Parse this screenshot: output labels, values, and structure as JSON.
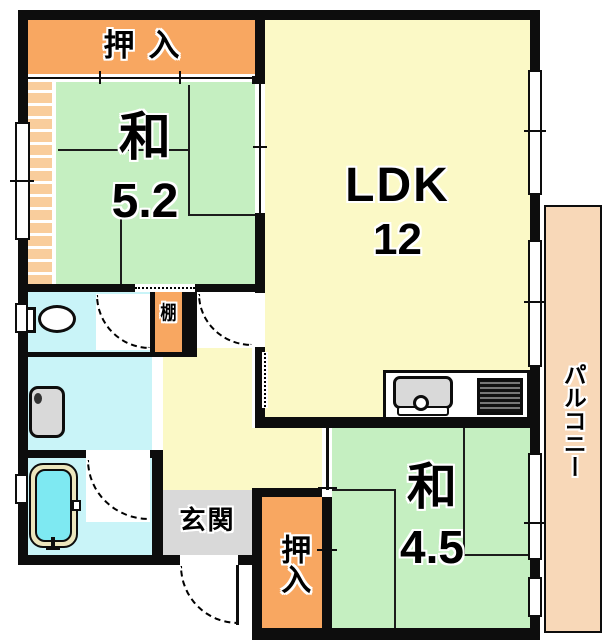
{
  "rooms": {
    "closet_top": {
      "label": "押入",
      "type": "closet"
    },
    "washitsu_main": {
      "label": "和",
      "size": "5.2",
      "type": "japanese-room"
    },
    "ldk": {
      "label": "LDK",
      "size": "12",
      "type": "living-dining-kitchen"
    },
    "balcony": {
      "label": "パルコニー",
      "type": "balcony"
    },
    "shelf": {
      "label": "棚",
      "type": "shelf"
    },
    "genkan": {
      "label": "玄関",
      "type": "entrance"
    },
    "closet_bottom": {
      "label": "押入",
      "type": "closet"
    },
    "washitsu_second": {
      "label": "和",
      "size": "4.5",
      "type": "japanese-room"
    }
  },
  "icons": {
    "toilet": "toilet-icon",
    "washbasin": "washbasin-icon",
    "bathtub": "bathtub-icon",
    "kitchen_sink": "kitchen-sink-icon",
    "stove": "stove-icon",
    "door_swing": "door-swing-arc-icon",
    "window": "window-marker-icon"
  },
  "colors": {
    "wall": "#0d0d0d",
    "tatami": "#c5efc1",
    "ldk_floor": "#fbf9c6",
    "closet": "#f8a761",
    "closet_light": "#f9cd9c",
    "water_room": "#c9f4f8",
    "bathtub_water": "#7ee9f2",
    "bathtub_rim": "#ece6bd",
    "genkan_floor": "#d9d9d9",
    "balcony_floor": "#f8d8b8",
    "fixture_gray": "#d9d9d9"
  }
}
